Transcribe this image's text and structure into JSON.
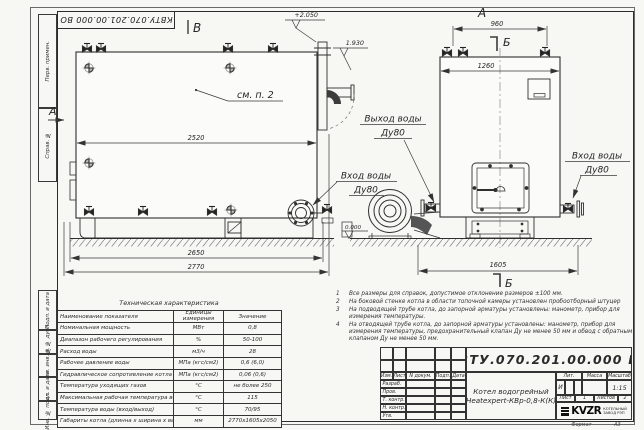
{
  "doc": {
    "number": "КВТУ.070.201.00.000  ВО"
  },
  "frame": {
    "side_labels": [
      "Перв. примен.",
      "Справ. №",
      "Подп. и дата",
      "Инв. № дубл.",
      "Взам. инв. №",
      "Подп. и дата",
      "Инв. № подл."
    ],
    "format_label": "Формат",
    "format_value": "А3"
  },
  "views": {
    "side": {
      "view_label": "В",
      "section_label": "А",
      "see_note": "см. п. 2",
      "elev_top": "+2.050",
      "elev_flue": "1.930",
      "level_zero": "0.000",
      "dim_2520": "2520",
      "dim_2650": "2650",
      "dim_2770": "2770",
      "outlet_line1": "Выход воды",
      "outlet_line2": "Ду80",
      "inlet_line1": "Вход воды",
      "inlet_line2": "Ду80"
    },
    "front": {
      "view_label": "А",
      "section_label_top": "Б",
      "section_label_bottom": "Б",
      "dim_960": "960",
      "dim_1260": "1260",
      "dim_1605": "1605",
      "inlet_line1": "Вход воды",
      "inlet_line2": "Ду80"
    }
  },
  "notes": [
    {
      "num": "1",
      "text": "Все размеры для справок, допустимое отклонение размеров ±100 мм."
    },
    {
      "num": "2",
      "text": "На боковой стенке котла в области топочной камеры установлен пробоотборный штуцер"
    },
    {
      "num": "3",
      "text": "На подводящей трубе котла, до запорной арматуры установлены: манометр, прибор для измерения температуры."
    },
    {
      "num": "4",
      "text": "На отводящей трубе котла, до запорной арматуры установлены: манометр, прибор для измерения температуры, предохранительный клапан Ду не менее 50 мм и обвод с обратным клапаном Ду не менее 50 мм."
    }
  ],
  "tech": {
    "title": "Техническая характеристика",
    "col_name": "Наименование показателя",
    "col_unit": "Единицы измерения",
    "col_value": "Значение",
    "rows": [
      {
        "name": "Номинальная мощность",
        "unit": "МВт",
        "value": "0,8"
      },
      {
        "name": "Диапазон рабочего регулирования",
        "unit": "%",
        "value": "50-100"
      },
      {
        "name": "Расход воды",
        "unit": "м3/ч",
        "value": "28"
      },
      {
        "name": "Рабочее давление воды",
        "unit": "МПа (кгс/см2)",
        "value": "0,6 (6,0)"
      },
      {
        "name": "Гидравлическое сопротивление котла",
        "unit": "МПа (кгс/см2)",
        "value": "0,06 (0,6)"
      },
      {
        "name": "Температура уходящих газов",
        "unit": "°С",
        "value": "не более 250"
      },
      {
        "name": "Максимальная рабочая температура воды",
        "unit": "°С",
        "value": "115"
      },
      {
        "name": "Температура воды (вход/выход)",
        "unit": "°С",
        "value": "70/95"
      },
      {
        "name": "Габариты котла (длинна х ширина х высота)",
        "unit": "мм",
        "value": "2770х1605х2050"
      }
    ]
  },
  "stamp": {
    "doc_number": "КВТУ.070.201.00.000  ВО",
    "cols": [
      "Изм.",
      "Лист",
      "N докум.",
      "Подп.",
      "Дата"
    ],
    "rows": [
      "Разраб.",
      "Пров.",
      "Т. контр.",
      "Н. контр.",
      "Утв."
    ],
    "name_line1": "Котел водогрейный",
    "name_line2": "Heatexpert-КВр-0,8-К(К)",
    "lit_label": "Лит.",
    "lit_value": "И",
    "mass_label": "Масса",
    "scale_label": "Масштаб",
    "scale_value": "1:15",
    "sheet_label": "Лист",
    "sheet_value": "1",
    "sheets_label": "Листов",
    "sheets_value": "2",
    "logo_text": "KVZR",
    "logo_sub1": "КОТЕЛЬНЫЙ",
    "logo_sub2": "ЗАВОД РЭП"
  }
}
